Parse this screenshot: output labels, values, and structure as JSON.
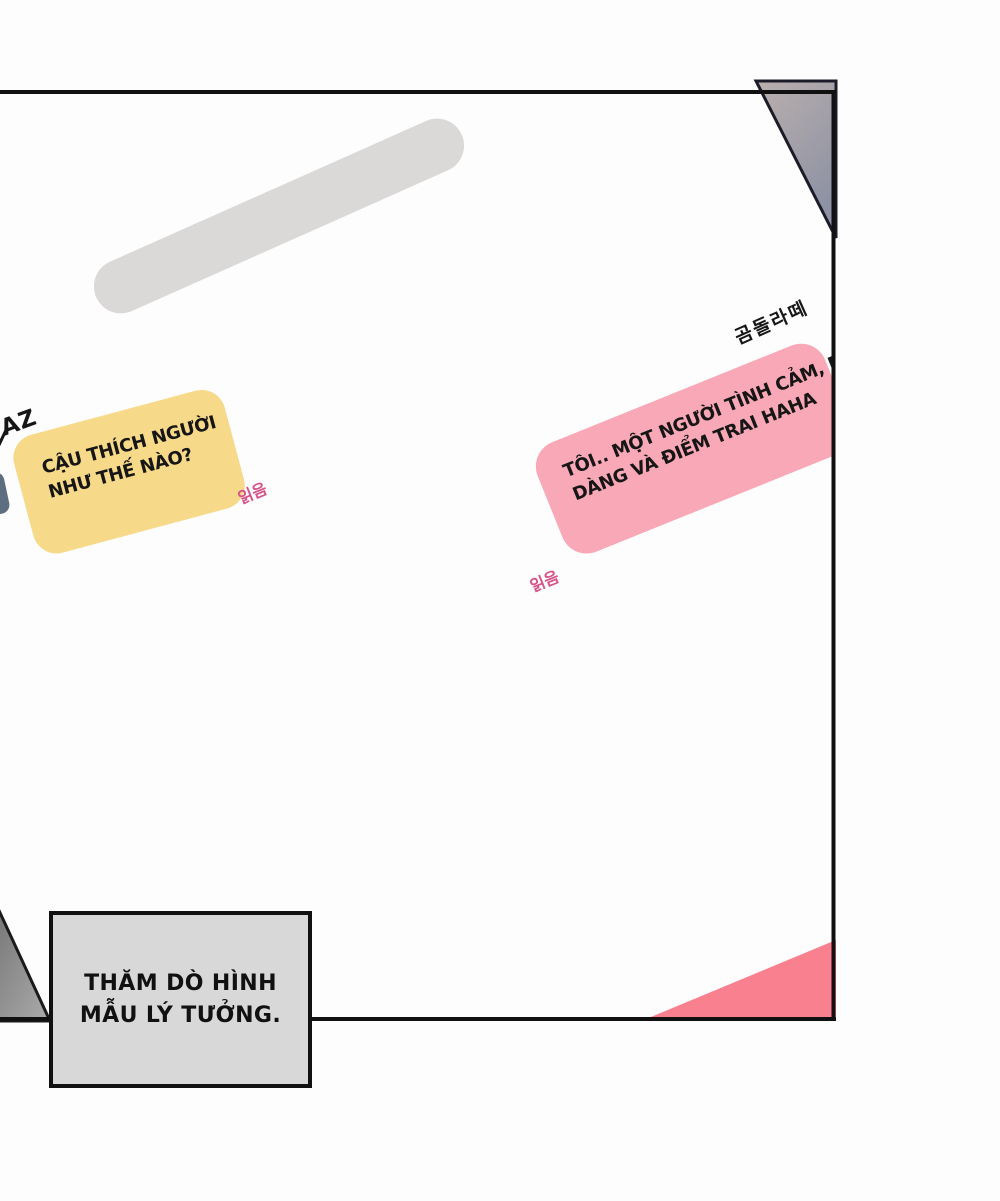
{
  "panel": {
    "background": "#fdfdfd",
    "border_color": "#111111"
  },
  "chat": {
    "draft_pill_color": "#dbd8d8",
    "text_color": "#161616",
    "read_label_color": "#d6538a",
    "right_message": {
      "sender_name": "곰돌라떼",
      "bubble_color": "#f8a8b6",
      "line1": "TÔI.. MỘT NGƯỜI TÌNH CẢM, DỊU",
      "line2": "DÀNG VÀ ĐIỂM TRAI HAHA",
      "read_label": "읽음"
    },
    "left_message": {
      "sender_name": "AZ",
      "bubble_color": "#f6d989",
      "line1": "CẬU THÍCH NGƯỜI",
      "line2": "NHƯ THẾ NÀO?",
      "read_label": "읽음"
    }
  },
  "caption": {
    "line1": "THĂM DÒ HÌNH",
    "line2": "MẪU LÝ TƯỞNG.",
    "fill_color": "#d8d8d8",
    "border_color": "#111111",
    "text_color": "#111111"
  },
  "decor": {
    "top_right_triangle_gradient_start": "#bab0ae",
    "top_right_triangle_gradient_end": "#8d91a3",
    "bottom_left_triangle_gradient_start": "#696969",
    "bottom_left_triangle_gradient_end": "#a8a8a8",
    "bottom_right_triangle_color": "#f8808f",
    "avatar_fragment_color": "#5d6e80"
  }
}
